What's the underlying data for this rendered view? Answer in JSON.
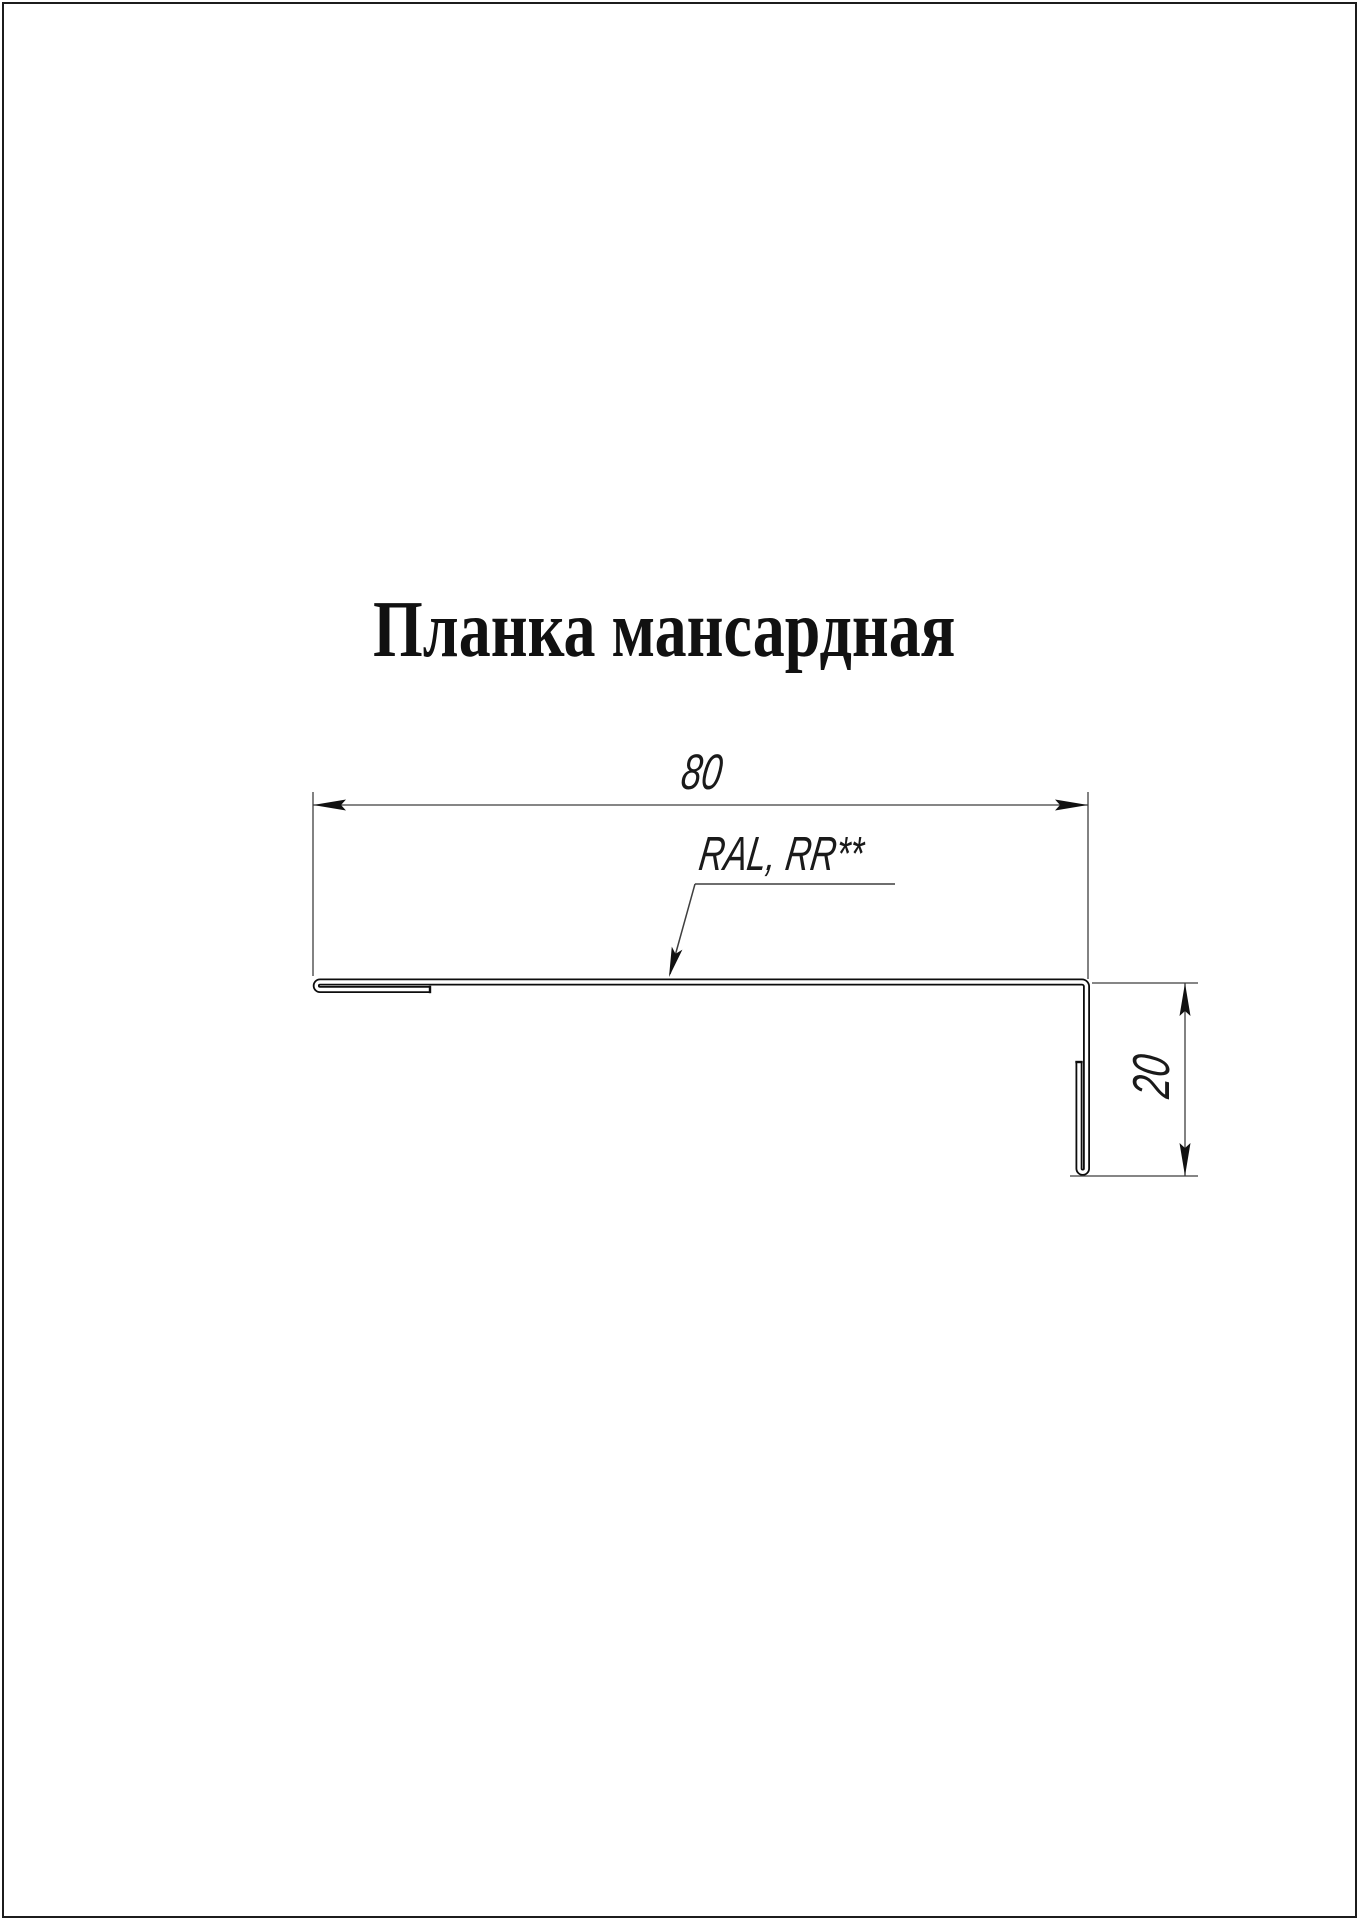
{
  "page": {
    "title": "Планка мансардная"
  },
  "drawing": {
    "part_name": "Планка мансардная",
    "dimensions": {
      "width_mm": "80",
      "height_mm": "20"
    },
    "labels": {
      "width_dim": "80",
      "height_dim": "20",
      "coating_label": "RAL, RR**"
    },
    "colors": {
      "background": "#ffffff",
      "page_border": "#1c1c1c",
      "profile_line": "#0d0d0d",
      "thin_line": "#3f3f3f",
      "text": "#1a1a1a"
    }
  }
}
